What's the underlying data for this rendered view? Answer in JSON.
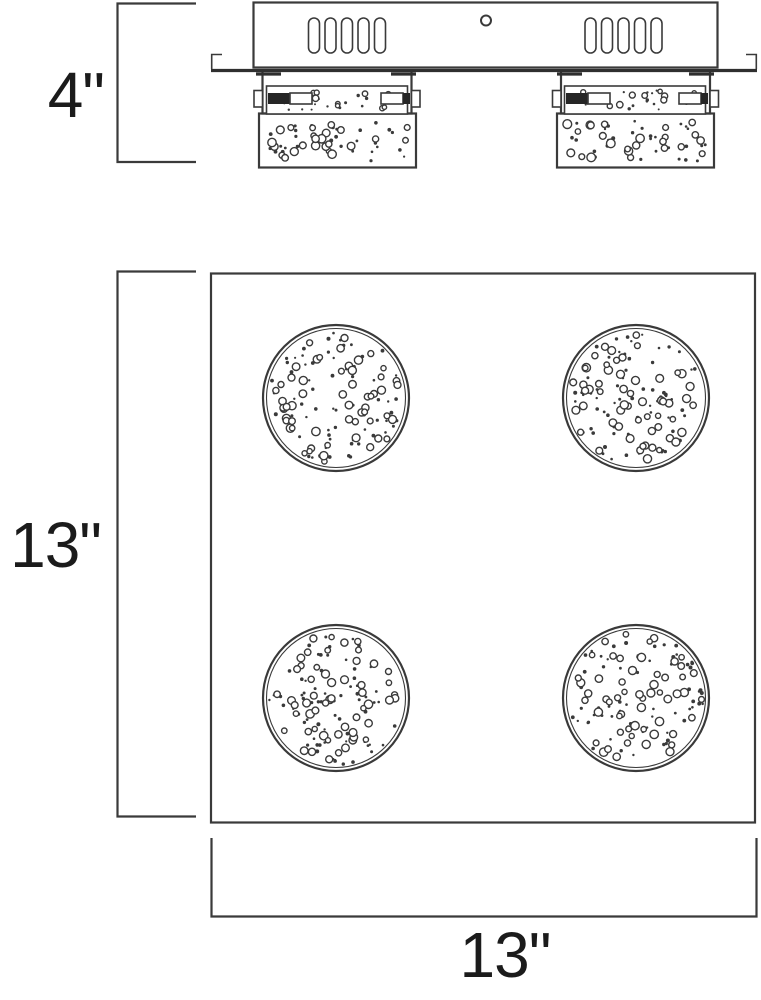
{
  "drawing": {
    "side_view": {
      "height_dim": "4\""
    },
    "bottom_view": {
      "height_dim": "13\"",
      "width_dim": "13\""
    }
  },
  "colors": {
    "line": "#3a3a3a",
    "line_heavy": "#2f2f2f",
    "text": "#1b1b1b",
    "background": "#ffffff"
  }
}
